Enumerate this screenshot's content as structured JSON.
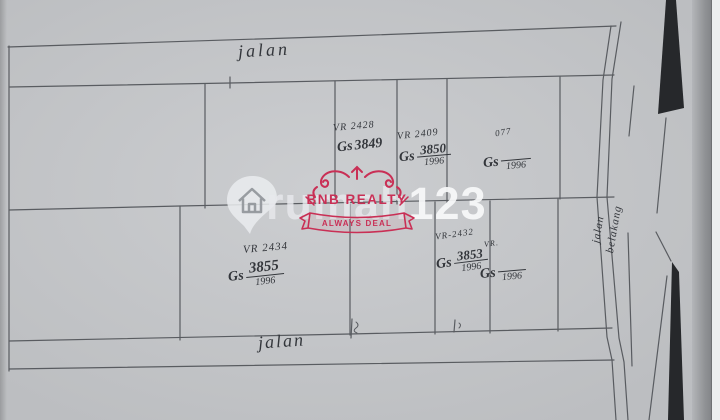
{
  "roads": {
    "top_label": "jalan",
    "bottom_label": "jalan",
    "right_label_1": "jalan",
    "right_label_2": "belakang"
  },
  "plots": [
    {
      "vr": "VR 2428",
      "gs": "Gs",
      "number": "3849",
      "year": ""
    },
    {
      "vr": "VR 2409",
      "gs": "Gs",
      "number": "3850",
      "year": "1996"
    },
    {
      "vr": "077",
      "gs": "Gs",
      "number": "",
      "year": "1996"
    },
    {
      "vr": "VR 2434",
      "gs": "Gs",
      "number": "3855",
      "year": "1996"
    },
    {
      "vr": "VR-2432",
      "gs": "Gs",
      "number": "3853",
      "year": "1996"
    },
    {
      "vr": "VR.",
      "gs": "Gs",
      "number": "",
      "year": "1996"
    }
  ],
  "watermark": {
    "brand_prefix": "rumah",
    "brand_suffix": "123",
    "icon": "house-location-pin-icon"
  },
  "stamp": {
    "title": "BNB REALTY",
    "banner": "ALWAYS DEAL",
    "accent_color": "#c92f55"
  },
  "colors": {
    "paper": "#c6c8cb",
    "ink": "#4e5156",
    "handwriting": "#33363b",
    "stamp_red": "#c92f55"
  }
}
